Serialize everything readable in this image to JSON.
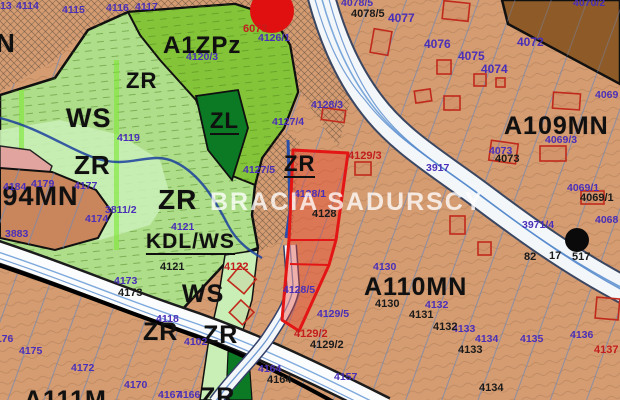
{
  "map": {
    "watermark": "BRACIA SADURSCY",
    "colors": {
      "tan": "#d59c72",
      "tan_dark": "#c9855c",
      "brown_dark": "#8d5a28",
      "green_light": "#aede8a",
      "green_mid": "#84c438",
      "green_dark": "#0c7a24",
      "mint": "#c9eeb6",
      "pink": "#e2a49e",
      "parcel_red": "#e31515",
      "marker_red": "#e01010",
      "label_purple": "#4a2fb8",
      "label_black": "#1a1a1a",
      "label_red": "#c41d1d",
      "water_blue": "#5588cc"
    },
    "highlight_parcel": {
      "numbers": [
        "4128/5",
        "4128/1",
        "4128"
      ],
      "zone": "ZR"
    },
    "labels": [
      {
        "t": "N",
        "x": -4,
        "y": 30,
        "k": "z",
        "s": 26
      },
      {
        "t": "A1ZPz",
        "x": 163,
        "y": 34,
        "k": "z",
        "s": 24
      },
      {
        "t": "ZR",
        "x": 126,
        "y": 70,
        "k": "z",
        "s": 22
      },
      {
        "t": "WS",
        "x": 66,
        "y": 105,
        "k": "z",
        "s": 27
      },
      {
        "t": "ZL",
        "x": 210,
        "y": 110,
        "k": "z",
        "s": 22,
        "u": 1
      },
      {
        "t": "ZR",
        "x": 74,
        "y": 152,
        "k": "z",
        "s": 26
      },
      {
        "t": "ZR",
        "x": 158,
        "y": 186,
        "k": "z",
        "s": 28
      },
      {
        "t": "A94MN",
        "x": -18,
        "y": 183,
        "k": "z",
        "s": 27
      },
      {
        "t": "KDL/WS",
        "x": 146,
        "y": 231,
        "k": "z",
        "s": 21,
        "u": 1
      },
      {
        "t": "ZR",
        "x": 284,
        "y": 153,
        "k": "z",
        "s": 22,
        "u": 1
      },
      {
        "t": "A109MN",
        "x": 504,
        "y": 114,
        "k": "z",
        "s": 25
      },
      {
        "t": "A110MN",
        "x": 364,
        "y": 275,
        "k": "z",
        "s": 25
      },
      {
        "t": "WS",
        "x": 182,
        "y": 282,
        "k": "z",
        "s": 25
      },
      {
        "t": "ZR",
        "x": 143,
        "y": 320,
        "k": "z",
        "s": 25
      },
      {
        "t": "ZR",
        "x": 203,
        "y": 323,
        "k": "z",
        "s": 25
      },
      {
        "t": "ZR",
        "x": 200,
        "y": 385,
        "k": "z",
        "s": 25
      },
      {
        "t": "A111M",
        "x": 24,
        "y": 388,
        "k": "z",
        "s": 25
      },
      {
        "t": "13",
        "x": 0,
        "y": 1,
        "k": "p"
      },
      {
        "t": "4114",
        "x": 16,
        "y": 1,
        "k": "p"
      },
      {
        "t": "4115",
        "x": 62,
        "y": 5,
        "k": "p"
      },
      {
        "t": "4116",
        "x": 106,
        "y": 3,
        "k": "p"
      },
      {
        "t": "4117",
        "x": 135,
        "y": 2,
        "k": "p"
      },
      {
        "t": "4119",
        "x": 117,
        "y": 133,
        "k": "p"
      },
      {
        "t": "4120/3",
        "x": 186,
        "y": 52,
        "k": "p"
      },
      {
        "t": "4126/1",
        "x": 258,
        "y": 33,
        "k": "p"
      },
      {
        "t": "4127/4",
        "x": 272,
        "y": 117,
        "k": "p"
      },
      {
        "t": "4127/5",
        "x": 243,
        "y": 165,
        "k": "p"
      },
      {
        "t": "4078/5",
        "x": 341,
        "y": -2,
        "k": "p"
      },
      {
        "t": "4077",
        "x": 388,
        "y": 12,
        "k": "pb"
      },
      {
        "t": "4076",
        "x": 424,
        "y": 38,
        "k": "pb"
      },
      {
        "t": "4075",
        "x": 458,
        "y": 50,
        "k": "pb"
      },
      {
        "t": "4074",
        "x": 481,
        "y": 63,
        "k": "pb"
      },
      {
        "t": "4072",
        "x": 517,
        "y": 36,
        "k": "pb"
      },
      {
        "t": "4070/2",
        "x": 573,
        "y": -2,
        "k": "p"
      },
      {
        "t": "4069",
        "x": 595,
        "y": 90,
        "k": "p"
      },
      {
        "t": "4069/3",
        "x": 545,
        "y": 135,
        "k": "p"
      },
      {
        "t": "4073",
        "x": 489,
        "y": 146,
        "k": "p"
      },
      {
        "t": "3917",
        "x": 426,
        "y": 163,
        "k": "p"
      },
      {
        "t": "4069/1",
        "x": 567,
        "y": 183,
        "k": "p"
      },
      {
        "t": "4068",
        "x": 595,
        "y": 215,
        "k": "p"
      },
      {
        "t": "3971/4",
        "x": 522,
        "y": 220,
        "k": "p"
      },
      {
        "t": "4128/3",
        "x": 311,
        "y": 100,
        "k": "p"
      },
      {
        "t": "4128/1",
        "x": 294,
        "y": 189,
        "k": "p"
      },
      {
        "t": "4128/5",
        "x": 283,
        "y": 285,
        "k": "p"
      },
      {
        "t": "4129/5",
        "x": 317,
        "y": 309,
        "k": "p"
      },
      {
        "t": "4130",
        "x": 373,
        "y": 262,
        "k": "p"
      },
      {
        "t": "4132",
        "x": 425,
        "y": 300,
        "k": "p"
      },
      {
        "t": "4133",
        "x": 452,
        "y": 324,
        "k": "p"
      },
      {
        "t": "4134",
        "x": 475,
        "y": 334,
        "k": "p"
      },
      {
        "t": "4135",
        "x": 520,
        "y": 334,
        "k": "p"
      },
      {
        "t": "4136",
        "x": 570,
        "y": 330,
        "k": "p"
      },
      {
        "t": "4157",
        "x": 334,
        "y": 372,
        "k": "p"
      },
      {
        "t": "4164",
        "x": 258,
        "y": 364,
        "k": "p"
      },
      {
        "t": "4167",
        "x": 158,
        "y": 390,
        "k": "p"
      },
      {
        "t": "4166",
        "x": 177,
        "y": 390,
        "k": "p"
      },
      {
        "t": "4170",
        "x": 124,
        "y": 380,
        "k": "p"
      },
      {
        "t": "4172",
        "x": 71,
        "y": 363,
        "k": "p"
      },
      {
        "t": "4173",
        "x": 114,
        "y": 276,
        "k": "p"
      },
      {
        "t": "4175",
        "x": 19,
        "y": 346,
        "k": "p"
      },
      {
        "t": "4176",
        "x": -10,
        "y": 334,
        "k": "p"
      },
      {
        "t": "4121",
        "x": 171,
        "y": 222,
        "k": "p"
      },
      {
        "t": "4118",
        "x": 156,
        "y": 314,
        "k": "p"
      },
      {
        "t": "4102",
        "x": 184,
        "y": 337,
        "k": "p"
      },
      {
        "t": "3811/2",
        "x": 105,
        "y": 205,
        "k": "p"
      },
      {
        "t": "3883",
        "x": 5,
        "y": 229,
        "k": "p"
      },
      {
        "t": "4174",
        "x": 85,
        "y": 214,
        "k": "p"
      },
      {
        "t": "4177",
        "x": 74,
        "y": 181,
        "k": "p"
      },
      {
        "t": "4179",
        "x": 31,
        "y": 179,
        "k": "p"
      },
      {
        "t": "4184",
        "x": 3,
        "y": 182,
        "k": "p"
      },
      {
        "t": "4078/5",
        "x": 351,
        "y": 9,
        "k": "k"
      },
      {
        "t": "4073",
        "x": 495,
        "y": 154,
        "k": "k"
      },
      {
        "t": "4069/1",
        "x": 580,
        "y": 193,
        "k": "k"
      },
      {
        "t": "4128",
        "x": 312,
        "y": 209,
        "k": "k"
      },
      {
        "t": "4129/2",
        "x": 310,
        "y": 340,
        "k": "k"
      },
      {
        "t": "4164",
        "x": 267,
        "y": 375,
        "k": "k"
      },
      {
        "t": "4130",
        "x": 375,
        "y": 299,
        "k": "k"
      },
      {
        "t": "4131",
        "x": 409,
        "y": 310,
        "k": "k"
      },
      {
        "t": "4132",
        "x": 433,
        "y": 322,
        "k": "k"
      },
      {
        "t": "4133",
        "x": 458,
        "y": 345,
        "k": "k"
      },
      {
        "t": "4134",
        "x": 479,
        "y": 383,
        "k": "k"
      },
      {
        "t": "4121",
        "x": 160,
        "y": 262,
        "k": "k"
      },
      {
        "t": "4173",
        "x": 118,
        "y": 288,
        "k": "k"
      },
      {
        "t": "82",
        "x": 524,
        "y": 252,
        "k": "k"
      },
      {
        "t": "17",
        "x": 549,
        "y": 251,
        "k": "k"
      },
      {
        "t": "517",
        "x": 572,
        "y": 252,
        "k": "k"
      },
      {
        "t": "6073",
        "x": 243,
        "y": 24,
        "k": "r"
      },
      {
        "t": "4129/3",
        "x": 348,
        "y": 151,
        "k": "r"
      },
      {
        "t": "4122",
        "x": 224,
        "y": 262,
        "k": "r"
      },
      {
        "t": "4129/2",
        "x": 294,
        "y": 329,
        "k": "r"
      },
      {
        "t": "4137",
        "x": 594,
        "y": 345,
        "k": "r"
      }
    ]
  }
}
